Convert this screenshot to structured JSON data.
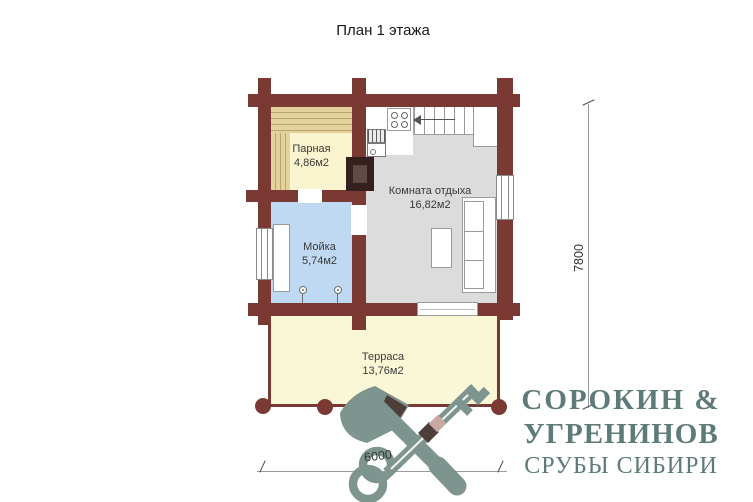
{
  "title": "План 1 этажа",
  "rooms": {
    "parnaya": {
      "name": "Парная",
      "area": "4,86м2"
    },
    "moyka": {
      "name": "Мойка",
      "area": "5,74м2"
    },
    "komnata": {
      "name": "Комната отдыха",
      "area": "16,82м2"
    },
    "terrasa": {
      "name": "Терраса",
      "area": "13,76м2"
    }
  },
  "dimensions": {
    "width_mm": "6000",
    "height_mm": "7800"
  },
  "logo": {
    "line1": "СОРОКИН &",
    "line2": "УГРЕНИНОВ",
    "line3": "СРУБЫ СИБИРИ",
    "icon": "crossed-axe-and-key"
  },
  "colors": {
    "wall": "#7a3a33",
    "parnaya_floor": "#faf5cf",
    "bench": "#d9c286",
    "moyka_floor": "#bed9f1",
    "komnata_floor": "#dcdcdc",
    "terrasa_floor": "#faf7d6",
    "stove": "#35201d",
    "logo_icon": "#7d948f",
    "logo_text": "#5d7b78"
  }
}
